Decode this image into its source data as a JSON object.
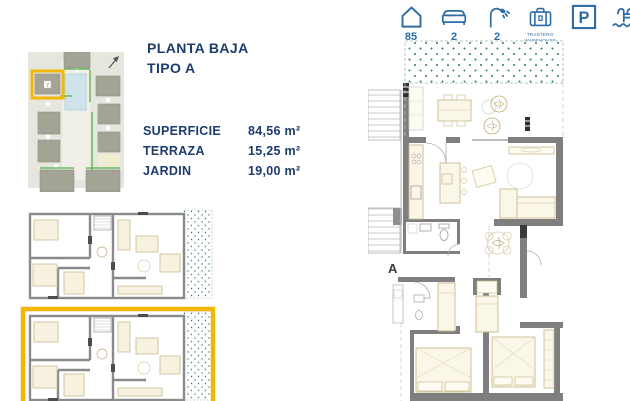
{
  "header": {
    "title_line1": "PLANTA BAJA",
    "title_line2": "TIPO A"
  },
  "specs": [
    {
      "label": "SUPERFICIE",
      "value": "84,56 m²"
    },
    {
      "label": "TERRAZA",
      "value": "15,25 m²"
    },
    {
      "label": "JARDIN",
      "value": "19,00 m²"
    }
  ],
  "amenity_bar": {
    "units": {
      "icon": "house-icon",
      "value": "85"
    },
    "bedrooms": {
      "icon": "bed-icon",
      "value": "2"
    },
    "bathrooms": {
      "icon": "shower-icon",
      "value": "2"
    },
    "storage": {
      "icon": "suitcase-icon",
      "line1": "TRASTERO",
      "line2": "WAREHOUSE"
    },
    "parking": {
      "icon": "parking-icon",
      "letter": "P"
    },
    "pool": {
      "icon": "pool-ladder-icon"
    }
  },
  "main_plan": {
    "unit_label": "A"
  },
  "site_plan": {
    "highlighted_unit_number": "7"
  },
  "colors": {
    "navy_text": "#1d3c6e",
    "icon_blue": "#2c6ba5",
    "highlight_yellow": "#f2b705",
    "wall_gray": "#7f7f7f",
    "furniture_tan": "#c9ba8e",
    "garden_dot_teal": "#2e7d6e"
  }
}
